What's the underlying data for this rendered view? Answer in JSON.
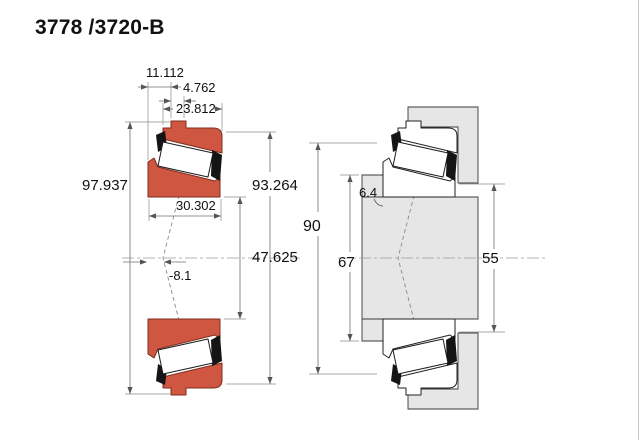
{
  "title": "3778 /3720-B",
  "colors": {
    "ring_fill": "#cf5640",
    "ring_stroke": "#7f2e1d",
    "metal_fill": "#e6e6e6",
    "dimension_line": "#6f6f6f"
  },
  "left_view": {
    "name": "bearing cross-section",
    "dims": {
      "flange_offset": "11.112",
      "flange_width": "4.762",
      "cup_width": "23.812",
      "flange_od": "97.937",
      "outer_diameter": "93.264",
      "overall_width": "30.302",
      "bore_diameter": "47.625",
      "effective_center": "-8.1"
    }
  },
  "right_view": {
    "name": "mounted abutment view",
    "dims": {
      "housing_bore": "90",
      "backing_ring_od": "67",
      "fillet_radius": "6.4",
      "shaft_backing_od": "55"
    }
  }
}
